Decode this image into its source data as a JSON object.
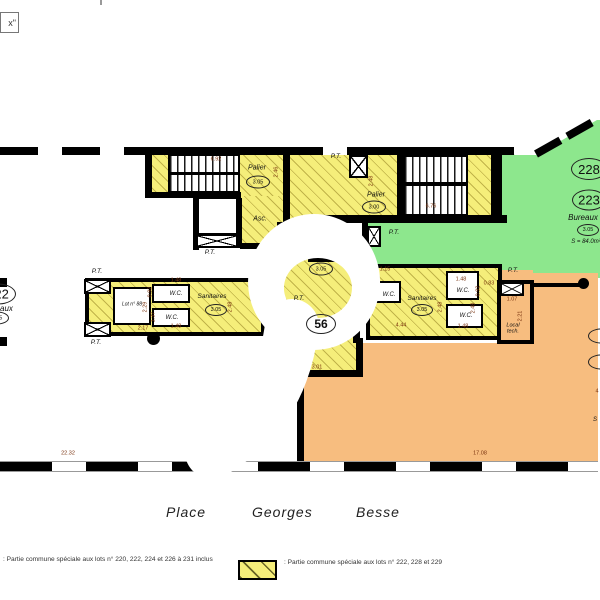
{
  "title_box": {
    "text": "x\""
  },
  "watermark_digit": "9",
  "street": {
    "words": [
      "Place",
      "Georges",
      "Besse"
    ]
  },
  "legend": {
    "item1": ": Partie commune spéciale aux lots n° 220, 222, 224 et 226 à 231 inclus",
    "item2": ": Partie commune spéciale aux lots n° 222, 228 et 229"
  },
  "colors": {
    "yellow": "#f5ee7a",
    "green": "#8de78d",
    "orange": "#f7bd7f",
    "wall": "#000000",
    "dimension_text": "#7a330f"
  },
  "plan": {
    "labels": [
      {
        "t": "Palier",
        "x": 257,
        "y": 168,
        "fs": 7,
        "k": "",
        "name": "label-palier-west"
      },
      {
        "t": "Palier",
        "x": 376,
        "y": 195,
        "fs": 7,
        "k": "",
        "name": "label-palier-east"
      },
      {
        "t": "Asc.",
        "x": 260,
        "y": 219,
        "fs": 7,
        "k": "",
        "name": "label-elevator"
      },
      {
        "t": "P.T.",
        "x": 210,
        "y": 253,
        "fs": 6.5,
        "k": "",
        "name": "label-pt-1"
      },
      {
        "t": "P.T.",
        "x": 336,
        "y": 157,
        "fs": 6.5,
        "k": "",
        "name": "label-pt-2"
      },
      {
        "t": "P.T.",
        "x": 394,
        "y": 233,
        "fs": 6.5,
        "k": "",
        "name": "label-pt-3"
      },
      {
        "t": "P.T.",
        "x": 97,
        "y": 272,
        "fs": 6.5,
        "k": "",
        "name": "label-pt-4"
      },
      {
        "t": "P.T.",
        "x": 96,
        "y": 343,
        "fs": 6.5,
        "k": "",
        "name": "label-pt-5"
      },
      {
        "t": "P.T.",
        "x": 513,
        "y": 271,
        "fs": 6.5,
        "k": "",
        "name": "label-pt-6"
      },
      {
        "t": "P.T.",
        "x": 299,
        "y": 299,
        "fs": 6.5,
        "k": "",
        "name": "label-pt-7"
      },
      {
        "t": "W.C.",
        "x": 176,
        "y": 294,
        "fs": 6,
        "k": "",
        "name": "label-wc-1"
      },
      {
        "t": "W.C.",
        "x": 172,
        "y": 318,
        "fs": 6,
        "k": "",
        "name": "label-wc-2"
      },
      {
        "t": "Sanitaires",
        "x": 212,
        "y": 297,
        "fs": 6.5,
        "k": "",
        "name": "label-sanitaires-west"
      },
      {
        "t": "Lot n° 88",
        "x": 132,
        "y": 305,
        "fs": 5,
        "k": "",
        "name": "label-lot-88"
      },
      {
        "t": "W.C.",
        "x": 389,
        "y": 295,
        "fs": 6,
        "k": "",
        "name": "label-wc-3"
      },
      {
        "t": "Sanitaires",
        "x": 422,
        "y": 299,
        "fs": 6.5,
        "k": "",
        "name": "label-sanitaires-east"
      },
      {
        "t": "W.C.",
        "x": 463,
        "y": 291,
        "fs": 6,
        "k": "",
        "name": "label-wc-4"
      },
      {
        "t": "W.C.",
        "x": 466,
        "y": 316,
        "fs": 6,
        "k": "",
        "name": "label-wc-5"
      },
      {
        "t": "Local tech.",
        "x": 513,
        "y": 329,
        "fs": 5.5,
        "k": "wrap",
        "w": 24,
        "name": "label-local-tech"
      },
      {
        "t": "Bureaux",
        "x": 583,
        "y": 218,
        "fs": 8,
        "k": "",
        "name": "label-bureaux-east"
      },
      {
        "t": "S = 84.0m²",
        "x": 586,
        "y": 242,
        "fs": 6,
        "k": "",
        "name": "label-surface-east"
      },
      {
        "t": "Bureaux",
        "x": -2,
        "y": 309,
        "fs": 8,
        "k": "",
        "name": "label-bureaux-west"
      },
      {
        "t": "S",
        "x": 595,
        "y": 420,
        "fs": 6,
        "k": "",
        "name": "label-partial-s"
      },
      {
        "t": "6.92",
        "x": 216,
        "y": 160,
        "fs": 5.5,
        "k": "dim",
        "name": "dim-6-92"
      },
      {
        "t": "2.46",
        "x": 277,
        "y": 172,
        "fs": 5.5,
        "k": "dim rot",
        "name": "dim-2-46"
      },
      {
        "t": "6.76",
        "x": 431,
        "y": 207,
        "fs": 5.5,
        "k": "dim",
        "name": "dim-6-76"
      },
      {
        "t": "2.48",
        "x": 372,
        "y": 181,
        "fs": 5.5,
        "k": "dim rot",
        "name": "dim-2-48-a"
      },
      {
        "t": "1.48",
        "x": 176,
        "y": 281,
        "fs": 5.5,
        "k": "dim",
        "name": "dim-1-48-a"
      },
      {
        "t": "0.92",
        "x": 151,
        "y": 292,
        "fs": 5.5,
        "k": "dim rot",
        "name": "dim-0-92-a"
      },
      {
        "t": "2.29",
        "x": 146,
        "y": 307,
        "fs": 5.5,
        "k": "dim rot",
        "name": "dim-2-29"
      },
      {
        "t": "1.37",
        "x": 154,
        "y": 317,
        "fs": 5.5,
        "k": "dim rot",
        "name": "dim-1-37"
      },
      {
        "t": "1.48",
        "x": 176,
        "y": 327,
        "fs": 5.5,
        "k": "dim",
        "name": "dim-1-48-b"
      },
      {
        "t": "2.17",
        "x": 143,
        "y": 329,
        "fs": 5.5,
        "k": "dim",
        "name": "dim-2-17"
      },
      {
        "t": "2.48",
        "x": 231,
        "y": 307,
        "fs": 5.5,
        "k": "dim rot",
        "name": "dim-2-48-b"
      },
      {
        "t": "3.01",
        "x": 317,
        "y": 368,
        "fs": 5.5,
        "k": "dim",
        "name": "dim-3-01"
      },
      {
        "t": "1.15",
        "x": 385,
        "y": 270,
        "fs": 5.5,
        "k": "dim",
        "name": "dim-1-15"
      },
      {
        "t": "4.44",
        "x": 401,
        "y": 326,
        "fs": 5.5,
        "k": "dim",
        "name": "dim-4-44"
      },
      {
        "t": "2.48",
        "x": 441,
        "y": 307,
        "fs": 5.5,
        "k": "dim rot",
        "name": "dim-2-48-c"
      },
      {
        "t": "1.48",
        "x": 461,
        "y": 280,
        "fs": 5.5,
        "k": "dim",
        "name": "dim-1-48-c"
      },
      {
        "t": "0.92",
        "x": 479,
        "y": 291,
        "fs": 5.5,
        "k": "dim rot",
        "name": "dim-0-92-b"
      },
      {
        "t": "0.83",
        "x": 489,
        "y": 284,
        "fs": 5.5,
        "k": "dim",
        "name": "dim-0-83"
      },
      {
        "t": "2.48",
        "x": 474,
        "y": 308,
        "fs": 5.5,
        "k": "dim rot",
        "name": "dim-2-48-d"
      },
      {
        "t": "1.48",
        "x": 463,
        "y": 327,
        "fs": 5.5,
        "k": "dim",
        "name": "dim-1-48-d"
      },
      {
        "t": "1.07",
        "x": 512,
        "y": 300,
        "fs": 5.5,
        "k": "dim",
        "name": "dim-1-07"
      },
      {
        "t": "2.21",
        "x": 521,
        "y": 316,
        "fs": 5.5,
        "k": "dim rot",
        "name": "dim-2-21"
      },
      {
        "t": "22.32",
        "x": 68,
        "y": 454,
        "fs": 5.5,
        "k": "dim",
        "name": "dim-22-32"
      },
      {
        "t": "17.08",
        "x": 480,
        "y": 454,
        "fs": 5.5,
        "k": "dim",
        "name": "dim-17-08"
      },
      {
        "t": "4",
        "x": 597,
        "y": 392,
        "fs": 5.5,
        "k": "dim",
        "name": "dim-partial-4"
      }
    ],
    "ovals": [
      {
        "t": "3.05",
        "x": 258,
        "y": 182,
        "w": 24,
        "h": 13,
        "fs": 5.5,
        "name": "oval-3-05-palier-west"
      },
      {
        "t": "3.00",
        "x": 374,
        "y": 207,
        "w": 24,
        "h": 13,
        "fs": 5.5,
        "name": "oval-3-00-palier-east"
      },
      {
        "t": "3.05",
        "x": 321,
        "y": 269,
        "w": 24,
        "h": 13,
        "fs": 5.5,
        "name": "oval-3-05-central"
      },
      {
        "t": "56",
        "x": 321,
        "y": 324,
        "w": 30,
        "h": 20,
        "fs": 12,
        "b": 1,
        "name": "oval-room-56"
      },
      {
        "t": "3.05",
        "x": 216,
        "y": 310,
        "w": 22,
        "h": 12,
        "fs": 5.5,
        "name": "oval-3-05-sanitaires-west"
      },
      {
        "t": "3.05",
        "x": 422,
        "y": 310,
        "w": 22,
        "h": 12,
        "fs": 5.5,
        "name": "oval-3-05-sanitaires-east"
      },
      {
        "t": "228",
        "x": 589,
        "y": 169,
        "w": 36,
        "h": 22,
        "fs": 13,
        "name": "oval-lot-228"
      },
      {
        "t": "223",
        "x": 589,
        "y": 200,
        "w": 34,
        "h": 21,
        "fs": 13,
        "name": "oval-lot-223"
      },
      {
        "t": "3.05",
        "x": 588,
        "y": 230,
        "w": 22,
        "h": 12,
        "fs": 5.5,
        "name": "oval-3-05-east"
      },
      {
        "t": "222",
        "x": -2,
        "y": 294,
        "w": 36,
        "h": 21,
        "fs": 13,
        "name": "oval-lot-222"
      },
      {
        "t": "3.05",
        "x": -3,
        "y": 318,
        "w": 24,
        "h": 13,
        "fs": 5.5,
        "name": "oval-3-05-west"
      }
    ],
    "partial_ovals": [
      {
        "x": 601,
        "y": 336,
        "w": 26,
        "h": 15
      },
      {
        "x": 601,
        "y": 362,
        "w": 26,
        "h": 15
      }
    ]
  }
}
